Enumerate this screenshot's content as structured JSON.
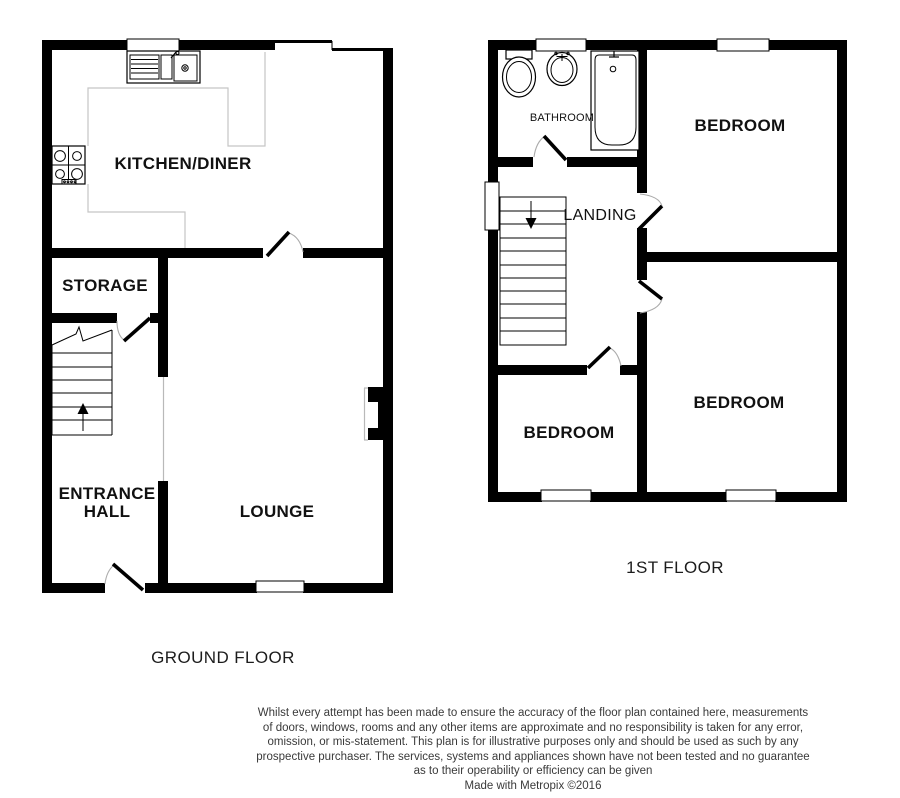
{
  "ground_floor": {
    "title": "GROUND FLOOR",
    "rooms": {
      "kitchen_diner": "KITCHEN/DINER",
      "storage": "STORAGE",
      "entrance_hall_line1": "ENTRANCE",
      "entrance_hall_line2": "HALL",
      "lounge": "LOUNGE"
    }
  },
  "first_floor": {
    "title": "1ST FLOOR",
    "rooms": {
      "bathroom": "BATHROOM",
      "bedroom_front": "BEDROOM",
      "landing": "LANDING",
      "bedroom_back_left": "BEDROOM",
      "bedroom_back_right": "BEDROOM"
    }
  },
  "disclaimer": {
    "lines": [
      "Whilst every attempt has been made to ensure the accuracy of the floor plan contained here, measurements",
      "of doors, windows, rooms and any other items are approximate and no responsibility is taken for any error,",
      "omission, or mis-statement. This plan is for illustrative purposes only and should be used as such by any",
      "prospective purchaser. The services, systems and appliances shown have not been tested and no guarantee",
      "as to their operability or efficiency can be given",
      "Made with Metropix ©2016"
    ]
  },
  "colors": {
    "wall": "#000000",
    "counter_line": "#c5c5c5",
    "door_arc": "#ababab",
    "background": "#ffffff"
  }
}
